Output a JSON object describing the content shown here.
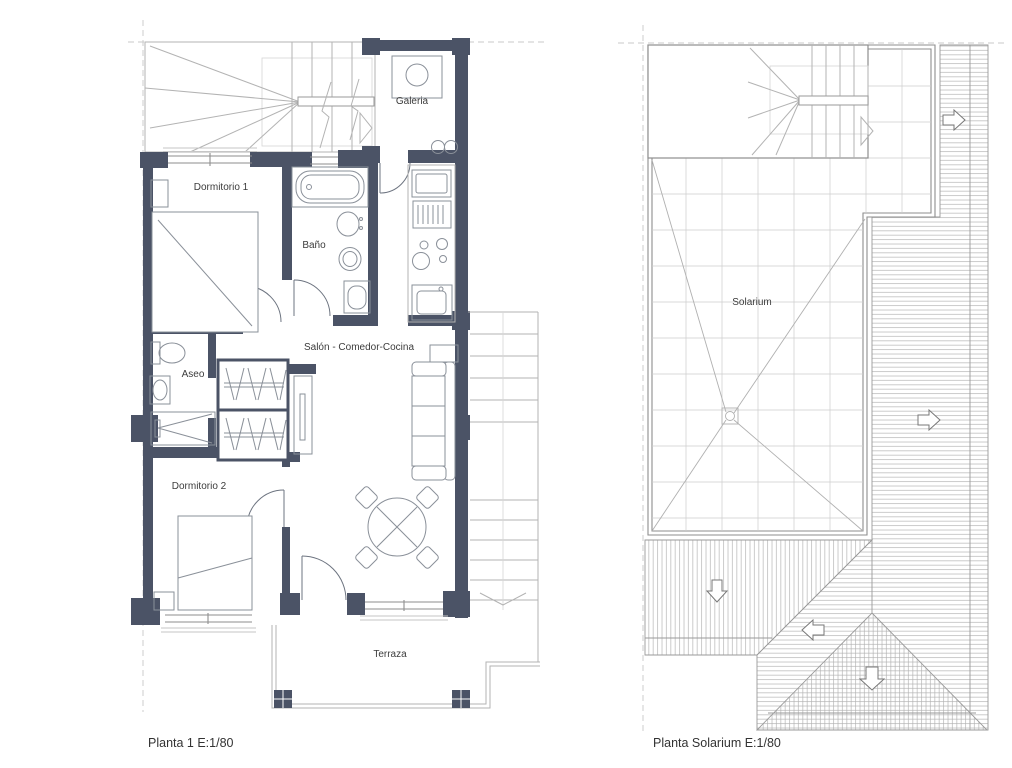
{
  "plan1": {
    "caption": "Planta 1 E:1/80",
    "rooms": {
      "galeria": "Galeria",
      "dormitorio1": "Dormitorio 1",
      "bano": "Baño",
      "aseo": "Aseo",
      "salon": "Salón - Comedor-Cocina",
      "dormitorio2": "Dormitorio 2",
      "terraza": "Terraza"
    }
  },
  "plan2": {
    "caption": "Planta Solarium E:1/80",
    "rooms": {
      "solarium": "Solarium"
    }
  },
  "colors": {
    "wall": "#4b5366",
    "furniture_line": "#8a9099",
    "stair_line": "#b3b3b3",
    "roof_hatch": "#b0b0b0",
    "grid": "#cccccc",
    "text": "#3c3c3c",
    "background": "#ffffff"
  }
}
